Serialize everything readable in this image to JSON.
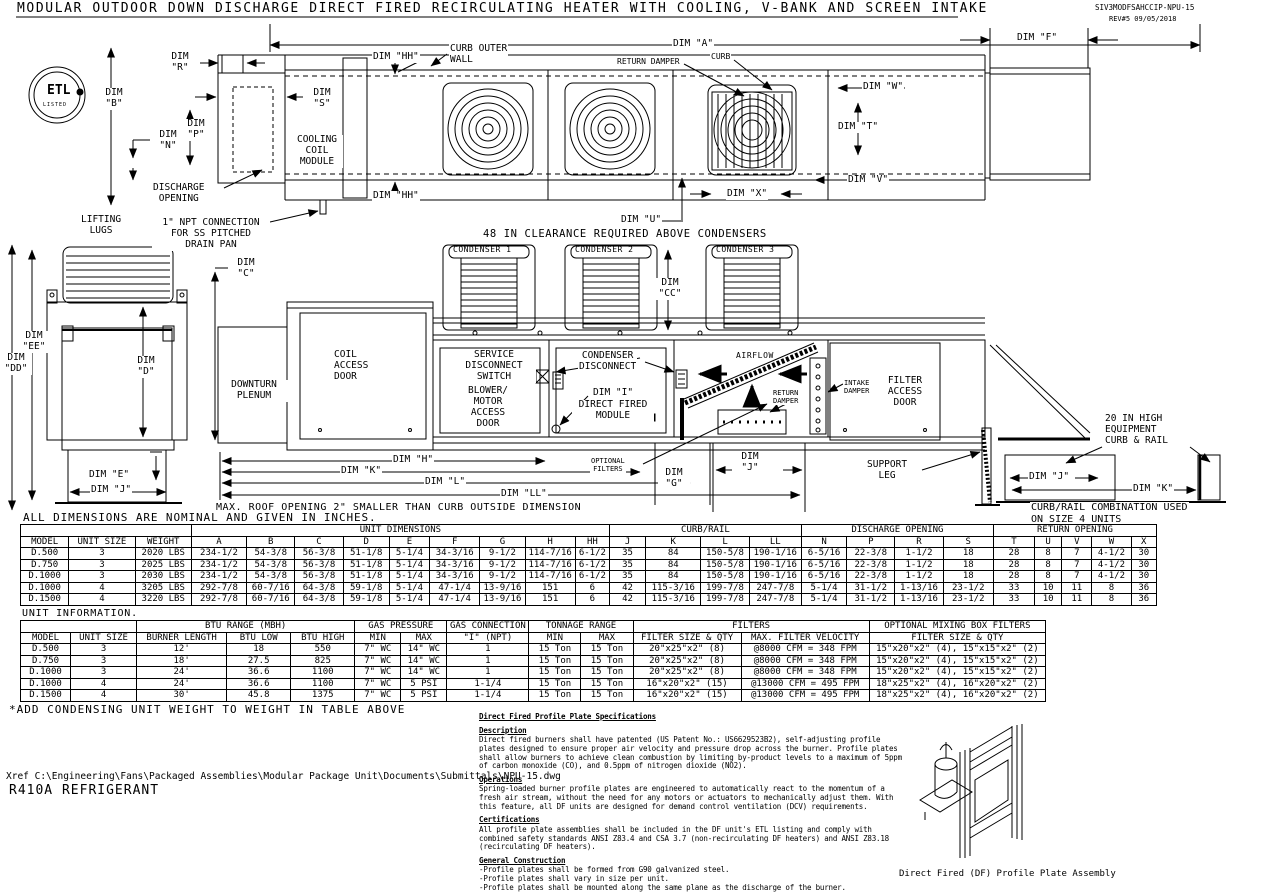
{
  "meta": {
    "title": "MODULAR OUTDOOR DOWN DISCHARGE DIRECT FIRED RECIRCULATING HEATER WITH COOLING, V-BANK AND SCREEN INTAKE",
    "drawing_number": "SIV3MODFSAHCCIP-NPU-15",
    "revision": "REV#5   09/05/2018"
  },
  "logo": {
    "text": "ETL",
    "sub": "LISTED"
  },
  "plan": {
    "dim_a": "DIM \"A\"",
    "dim_f": "DIM \"F\"",
    "dim_b": "DIM\n\"B\"",
    "dim_r": "DIM\n\"R\"",
    "dim_s": "DIM\n\"S\"",
    "dim_p": "DIM\n\"P\"",
    "dim_n": "DIM\n\"N\"",
    "dim_hh_top": "DIM \"HH\"",
    "dim_hh_bottom": "DIM \"HH\"",
    "discharge_opening": "DISCHARGE\nOPENING",
    "cooling_coil_module": "COOLING\nCOIL\nMODULE",
    "curb_outer_wall": "CURB OUTER\nWALL",
    "return_damper": "RETURN DAMPER",
    "curb": "CURB",
    "dim_w": "DIM \"W\"",
    "dim_t": "DIM \"T\"",
    "dim_v": "DIM \"V\"",
    "dim_x": "DIM \"X\"",
    "dim_u": "DIM \"U\"",
    "lifting_lugs": "LIFTING\nLUGS",
    "npt_connection": "1\" NPT CONNECTION\nFOR SS PITCHED\nDRAIN PAN"
  },
  "elevation": {
    "clearance_note": "48 IN CLEARANCE REQUIRED ABOVE CONDENSERS",
    "condenser_1": "CONDENSER 1",
    "condenser_2": "CONDENSER 2",
    "condenser_3": "CONDENSER 3",
    "dim_c": "DIM\n\"C\"",
    "dim_cc": "DIM\n\"CC\"",
    "dim_ee": "DIM\n\"EE\"",
    "dim_dd": "DIM\n\"DD\"",
    "dim_d": "DIM\n\"D\"",
    "dim_e": "DIM \"E\"",
    "dim_j_left": "DIM \"J\"",
    "downturn_plenum": "DOWNTURN\nPLENUM",
    "coil_access_door": "COIL\nACCESS\nDOOR",
    "service_disconnect": "SERVICE\nDISCONNECT\nSWITCH",
    "blower_motor_access": "BLOWER/\nMOTOR\nACCESS\nDOOR",
    "condenser_disconnect": "CONDENSER\nDISCONNECT",
    "dim_i": "DIM \"I\"",
    "direct_fired_module": "DIRECT FIRED\nMODULE",
    "airflow": "AIRFLOW",
    "return_damper": "RETURN\nDAMPER",
    "intake_damper": "INTAKE\nDAMPER",
    "filter_access_door": "FILTER\nACCESS\nDOOR",
    "optional_filters": "OPTIONAL\nFILTERS",
    "dim_g": "DIM\n\"G\"",
    "dim_j_mid": "DIM\n\"J\"",
    "dim_h": "DIM \"H\"",
    "dim_k": "DIM \"K\"",
    "dim_l": "DIM \"L\"",
    "dim_ll": "DIM \"LL\"",
    "support_leg": "SUPPORT\nLEG",
    "roof_note": "MAX. ROOF OPENING 2\" SMALLER THAN CURB OUTSIDE DIMENSION",
    "curb_rail_label": "20 IN HIGH\nEQUIPMENT\nCURB & RAIL",
    "dim_j_curb": "DIM \"J\"",
    "dim_k_curb": "DIM \"K\"",
    "curb_rail_note": "CURB/RAIL COMBINATION USED\nON SIZE 4 UNITS"
  },
  "notes": {
    "dims_nominal": "ALL DIMENSIONS ARE NOMINAL AND GIVEN IN INCHES.",
    "unit_information": "UNIT INFORMATION.",
    "add_weight": "*ADD CONDENSING UNIT WEIGHT TO WEIGHT IN TABLE ABOVE",
    "xref": "Xref C:\\Engineering\\Fans\\Packaged Assemblies\\Modular Package Unit\\Documents\\Submittals\\NPU-15.dwg",
    "refrigerant": "R410A REFRIGERANT"
  },
  "dimension_table": {
    "groups": [
      {
        "label": "",
        "span": 3
      },
      {
        "label": "UNIT DIMENSIONS",
        "span": 9
      },
      {
        "label": "CURB/RAIL",
        "span": 4
      },
      {
        "label": "DISCHARGE OPENING",
        "span": 4
      },
      {
        "label": "RETURN OPENING",
        "span": 5
      }
    ],
    "headers": [
      "MODEL",
      "UNIT SIZE",
      "WEIGHT",
      "A",
      "B",
      "C",
      "D",
      "E",
      "F",
      "G",
      "H",
      "HH",
      "J",
      "K",
      "L",
      "LL",
      "N",
      "P",
      "R",
      "S",
      "T",
      "U",
      "V",
      "W",
      "X"
    ],
    "rows": [
      [
        "D.500",
        "3",
        "2020 LBS",
        "234-1/2",
        "54-3/8",
        "56-3/8",
        "51-1/8",
        "5-1/4",
        "34-3/16",
        "9-1/2",
        "114-7/16",
        "6-1/2",
        "35",
        "84",
        "150-5/8",
        "190-1/16",
        "6-5/16",
        "22-3/8",
        "1-1/2",
        "18",
        "28",
        "8",
        "7",
        "4-1/2",
        "30"
      ],
      [
        "D.750",
        "3",
        "2025 LBS",
        "234-1/2",
        "54-3/8",
        "56-3/8",
        "51-1/8",
        "5-1/4",
        "34-3/16",
        "9-1/2",
        "114-7/16",
        "6-1/2",
        "35",
        "84",
        "150-5/8",
        "190-1/16",
        "6-5/16",
        "22-3/8",
        "1-1/2",
        "18",
        "28",
        "8",
        "7",
        "4-1/2",
        "30"
      ],
      [
        "D.1000",
        "3",
        "2030 LBS",
        "234-1/2",
        "54-3/8",
        "56-3/8",
        "51-1/8",
        "5-1/4",
        "34-3/16",
        "9-1/2",
        "114-7/16",
        "6-1/2",
        "35",
        "84",
        "150-5/8",
        "190-1/16",
        "6-5/16",
        "22-3/8",
        "1-1/2",
        "18",
        "28",
        "8",
        "7",
        "4-1/2",
        "30"
      ],
      [
        "D.1000",
        "4",
        "3205 LBS",
        "292-7/8",
        "60-7/16",
        "64-3/8",
        "59-1/8",
        "5-1/4",
        "47-1/4",
        "13-9/16",
        "151",
        "6",
        "42",
        "115-3/16",
        "199-7/8",
        "247-7/8",
        "5-1/4",
        "31-1/2",
        "1-13/16",
        "23-1/2",
        "33",
        "10",
        "11",
        "8",
        "36"
      ],
      [
        "D.1500",
        "4",
        "3220 LBS",
        "292-7/8",
        "60-7/16",
        "64-3/8",
        "59-1/8",
        "5-1/4",
        "47-1/4",
        "13-9/16",
        "151",
        "6",
        "42",
        "115-3/16",
        "199-7/8",
        "247-7/8",
        "5-1/4",
        "31-1/2",
        "1-13/16",
        "23-1/2",
        "33",
        "10",
        "11",
        "8",
        "36"
      ]
    ]
  },
  "info_table": {
    "groups": [
      {
        "label": "",
        "span": 2
      },
      {
        "label": "BTU RANGE (MBH)",
        "span": 3
      },
      {
        "label": "GAS PRESSURE",
        "span": 2
      },
      {
        "label": "GAS CONNECTION",
        "span": 1
      },
      {
        "label": "TONNAGE RANGE",
        "span": 2
      },
      {
        "label": "FILTERS",
        "span": 2
      },
      {
        "label": "OPTIONAL MIXING BOX FILTERS",
        "span": 1
      }
    ],
    "headers": [
      "MODEL",
      "UNIT SIZE",
      "BURNER LENGTH",
      "BTU LOW",
      "BTU HIGH",
      "MIN",
      "MAX",
      "\"I\" (NPT)",
      "MIN",
      "MAX",
      "FILTER SIZE & QTY",
      "MAX. FILTER VELOCITY",
      "FILTER SIZE & QTY"
    ],
    "rows": [
      [
        "D.500",
        "3",
        "12'",
        "18",
        "550",
        "7\" WC",
        "14\" WC",
        "1",
        "15 Ton",
        "15 Ton",
        "20\"x25\"x2\" (8)",
        "@8000 CFM = 348 FPM",
        "15\"x20\"x2\" (4), 15\"x15\"x2\" (2)"
      ],
      [
        "D.750",
        "3",
        "18'",
        "27.5",
        "825",
        "7\" WC",
        "14\" WC",
        "1",
        "15 Ton",
        "15 Ton",
        "20\"x25\"x2\" (8)",
        "@8000 CFM = 348 FPM",
        "15\"x20\"x2\" (4), 15\"x15\"x2\" (2)"
      ],
      [
        "D.1000",
        "3",
        "24'",
        "36.6",
        "1100",
        "7\" WC",
        "14\" WC",
        "1",
        "15 Ton",
        "15 Ton",
        "20\"x25\"x2\" (8)",
        "@8000 CFM = 348 FPM",
        "15\"x20\"x2\" (4), 15\"x15\"x2\" (2)"
      ],
      [
        "D.1000",
        "4",
        "24'",
        "36.6",
        "1100",
        "7\" WC",
        "5 PSI",
        "1-1/4",
        "15 Ton",
        "15 Ton",
        "16\"x20\"x2\" (15)",
        "@13000 CFM = 495 FPM",
        "18\"x25\"x2\" (4), 16\"x20\"x2\" (2)"
      ],
      [
        "D.1500",
        "4",
        "30'",
        "45.8",
        "1375",
        "7\" WC",
        "5 PSI",
        "1-1/4",
        "15 Ton",
        "15 Ton",
        "16\"x20\"x2\" (15)",
        "@13000 CFM = 495 FPM",
        "18\"x25\"x2\" (4), 16\"x20\"x2\" (2)"
      ]
    ]
  },
  "specs": {
    "title": "Direct Fired Profile Plate Specifications",
    "sections": [
      {
        "heading": "Description",
        "body": "Direct fired burners shall have patented (US Patent No.: US6629523B2), self-adjusting profile plates designed to ensure proper air velocity and pressure drop across the burner. Profile plates shall allow burners to achieve clean combustion by limiting by-product levels to a maximum of 5ppm of carbon monoxide (CO), and 0.5ppm of nitrogen dioxide (NO2)."
      },
      {
        "heading": "Operations",
        "body": "Spring-loaded burner profile plates are engineered to automatically react to the momentum of a fresh air stream, without the need for any motors or actuators to mechanically adjust them. With this feature, all DF units are designed for demand control ventilation (DCV) requirements."
      },
      {
        "heading": "Certifications",
        "body": "All profile plate assemblies shall be included in the DF unit's ETL listing and comply with combined safety standards ANSI Z83.4 and CSA 3.7 (non-recirculating DF heaters) and ANSI Z83.18 (recirculating DF heaters)."
      },
      {
        "heading": "General Construction",
        "body": "-Profile plates shall be formed from G90 galvanized steel.\n-Profile plates shall vary in size per unit.\n-Profile plates shall be mounted along the same plane as the discharge of the burner.\n-Design shall incorporate properly torqued, permanently mounted spring hinges.\n-Spring hinges shall be made from plated steel."
      }
    ]
  },
  "assembly_caption": "Direct Fired (DF) Profile Plate Assembly"
}
